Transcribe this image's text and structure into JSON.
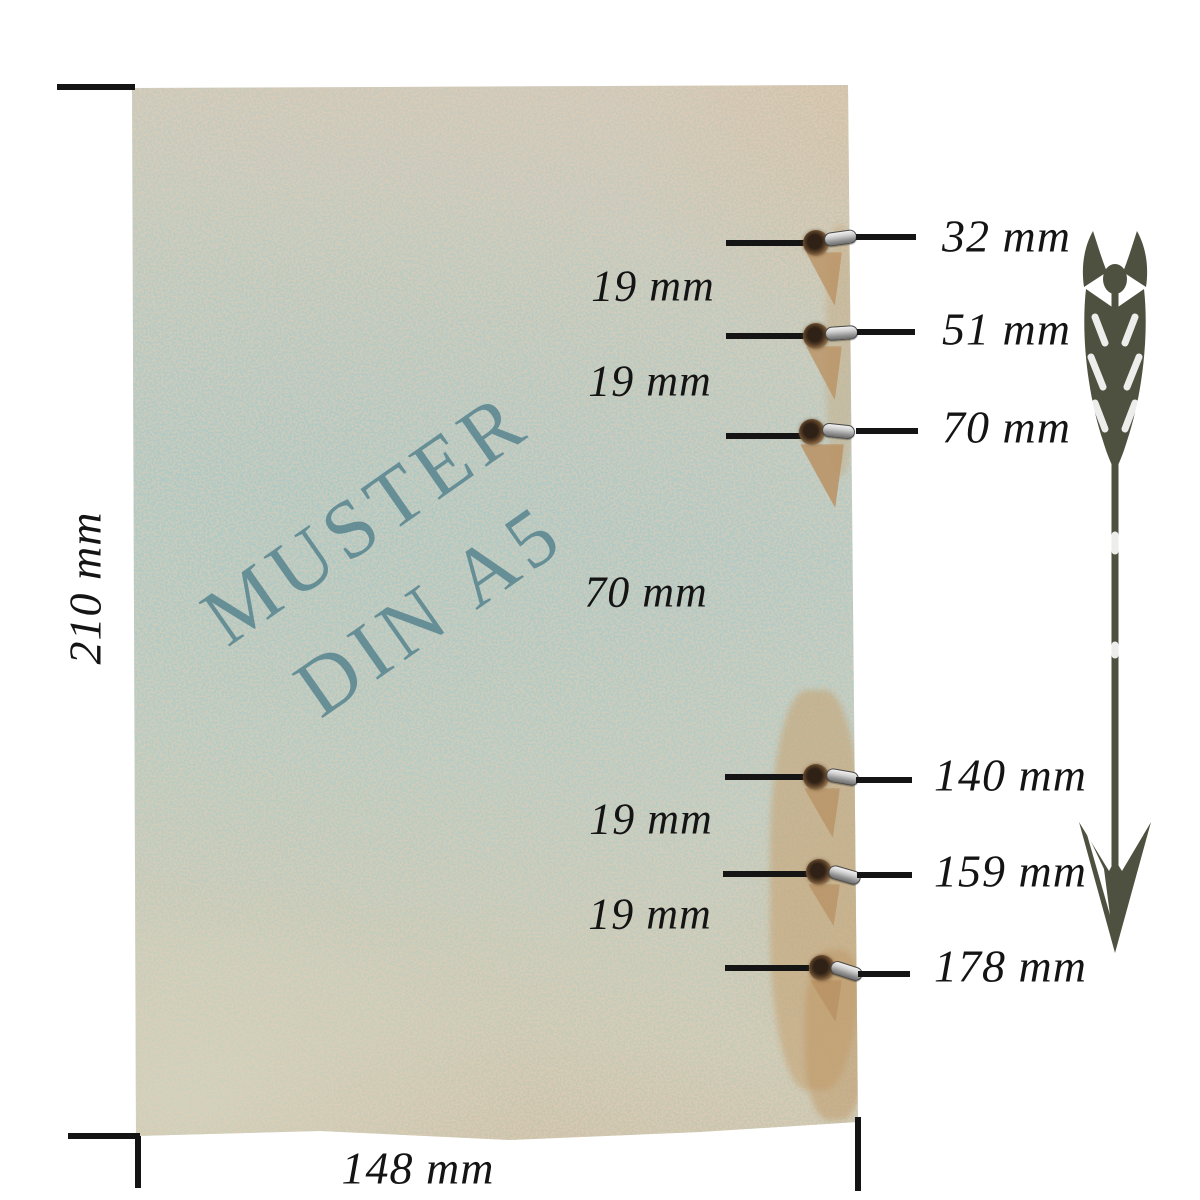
{
  "watermark": {
    "line1": "MUSTER",
    "line2": "DIN A5"
  },
  "page_dimensions": {
    "height_label": "210 mm",
    "width_label": "148 mm"
  },
  "holes": [
    {
      "label": "32 mm"
    },
    {
      "label": "51 mm"
    },
    {
      "label": "70 mm"
    },
    {
      "label": "140 mm"
    },
    {
      "label": "159 mm"
    },
    {
      "label": "178 mm"
    }
  ],
  "gaps": [
    {
      "label": "19 mm"
    },
    {
      "label": "19 mm"
    },
    {
      "label": "70 mm"
    },
    {
      "label": "19 mm"
    },
    {
      "label": "19 mm"
    }
  ],
  "colors": {
    "watermark": "#54828d",
    "arrow": "#4e5140",
    "line": "#141414",
    "paper_teal": "#b3cac5",
    "paper_beige": "#d2c8b8",
    "eyelet_brown": "#5a4027",
    "ring_silver": "#cfcfcf"
  }
}
